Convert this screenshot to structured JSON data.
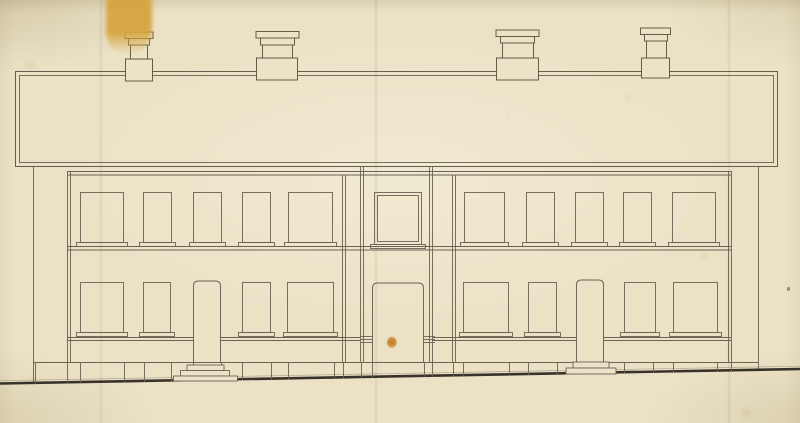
{
  "document": {
    "description": "Scanned front elevation drawing (ink on aged paper) of a two-storey terraced building with a parapet roof band, four chimney stacks, a projecting central entrance bay and two side doors with steps"
  },
  "palette": {
    "paper": "#ece3c7",
    "ink": "#6a6254",
    "ink_dark": "#55503f",
    "ground": "#38332a",
    "stain_yellow": "#d6a23c",
    "stain_orange": "#c67c26",
    "speck_brown": "#6e5f46"
  },
  "drawing": {
    "canvas": {
      "w": 800,
      "h": 423
    },
    "parapet": {
      "outer": [
        15.5,
        71.5,
        762,
        95
      ],
      "inner": [
        19.5,
        75.5,
        754,
        87
      ]
    },
    "chimneys": [
      {
        "name": "chimney-1",
        "parts": {
          "base": [
            125.5,
            59,
            27,
            22
          ],
          "stack": [
            130.5,
            44,
            17,
            15
          ],
          "neck": [
            128.5,
            38,
            21,
            7
          ],
          "cap": [
            125,
            32,
            28,
            6.5
          ]
        }
      },
      {
        "name": "chimney-2",
        "parts": {
          "base": [
            256.5,
            58,
            41,
            22
          ],
          "stack": [
            262.5,
            44,
            30,
            14
          ],
          "neck": [
            260.5,
            38,
            34,
            7
          ],
          "cap": [
            256,
            31.5,
            43,
            6.5
          ]
        }
      },
      {
        "name": "chimney-3",
        "parts": {
          "base": [
            496.5,
            58,
            42,
            22
          ],
          "stack": [
            502.5,
            42,
            31,
            16
          ],
          "neck": [
            500.5,
            36,
            34,
            7
          ],
          "cap": [
            496,
            30,
            43,
            6.5
          ]
        }
      },
      {
        "name": "chimney-4",
        "parts": {
          "base": [
            641.5,
            58,
            28,
            20
          ],
          "stack": [
            646.5,
            40,
            20,
            18
          ],
          "neck": [
            644.5,
            34,
            23,
            7
          ],
          "cap": [
            640.5,
            28,
            30,
            6.5
          ]
        }
      }
    ],
    "bands": [
      {
        "name": "eave-line-upper",
        "x1": 67,
        "x2": 731,
        "y": 171.5
      },
      {
        "name": "eave-line-lower",
        "x1": 67,
        "x2": 731,
        "y": 175
      },
      {
        "name": "string-course-upper",
        "x1": 67,
        "x2": 731,
        "y": 246.5
      },
      {
        "name": "string-course-lower",
        "x1": 67,
        "x2": 731,
        "y": 250
      },
      {
        "name": "plinth-top",
        "x1": 33,
        "x2": 758,
        "y": 362.5
      }
    ],
    "walls": [
      {
        "name": "left-end-wall",
        "x": 33.5,
        "y1": 167,
        "y2": 382
      },
      {
        "name": "facade-left-edge-outer",
        "x": 67.5,
        "y1": 171,
        "y2": 362.5
      },
      {
        "name": "facade-left-edge-inner",
        "x": 70.5,
        "y1": 171,
        "y2": 362.5
      },
      {
        "name": "porch-bay-left-outer",
        "x": 360.5,
        "y1": 167,
        "y2": 362.5
      },
      {
        "name": "porch-bay-left-inner",
        "x": 363.5,
        "y1": 167,
        "y2": 362.5
      },
      {
        "name": "porch-bay-right-inner",
        "x": 429.5,
        "y1": 167,
        "y2": 362.5
      },
      {
        "name": "porch-bay-right-outer",
        "x": 432.5,
        "y1": 167,
        "y2": 362.5
      },
      {
        "name": "downpipe-left-a",
        "x": 342.5,
        "y1": 175,
        "y2": 362
      },
      {
        "name": "downpipe-left-b",
        "x": 345.5,
        "y1": 175,
        "y2": 362
      },
      {
        "name": "downpipe-right-a",
        "x": 452.5,
        "y1": 175,
        "y2": 362
      },
      {
        "name": "downpipe-right-b",
        "x": 455.5,
        "y1": 175,
        "y2": 362
      },
      {
        "name": "facade-right-edge-inner",
        "x": 728.5,
        "y1": 171,
        "y2": 362.5
      },
      {
        "name": "facade-right-edge-outer",
        "x": 731.5,
        "y1": 171,
        "y2": 362.5
      },
      {
        "name": "right-end-wall",
        "x": 758.5,
        "y1": 167,
        "y2": 370
      }
    ],
    "sill_band": {
      "ys": [
        337.5,
        340.5
      ],
      "segments": [
        [
          67,
          193
        ],
        [
          221,
          360
        ],
        [
          433,
          576
        ],
        [
          604,
          731
        ]
      ]
    },
    "windows_upper": [
      [
        80.5,
        192.5,
        43,
        50
      ],
      [
        143.5,
        192.5,
        28,
        50
      ],
      [
        193.5,
        192.5,
        28,
        50
      ],
      [
        242.5,
        192.5,
        28,
        50
      ],
      [
        288.5,
        192.5,
        44,
        50
      ],
      [
        464.5,
        192.5,
        40,
        50
      ],
      [
        526.5,
        192.5,
        28,
        50
      ],
      [
        575.5,
        192.5,
        28,
        50
      ],
      [
        623.5,
        192.5,
        28,
        50
      ],
      [
        672.5,
        192.5,
        43,
        50
      ]
    ],
    "windows_lower": [
      [
        80.5,
        282.5,
        43,
        50
      ],
      [
        143.5,
        282.5,
        27,
        50
      ],
      [
        242.5,
        282.5,
        28,
        50
      ],
      [
        287.5,
        282.5,
        46,
        50
      ],
      [
        463.5,
        282.5,
        45,
        50
      ],
      [
        528.5,
        282.5,
        28,
        50
      ],
      [
        624.5,
        282.5,
        31,
        50
      ],
      [
        673.5,
        282.5,
        44,
        50
      ]
    ],
    "sill_inset": 4,
    "sill_h": 4,
    "center_window": {
      "outer": [
        374.5,
        192.5,
        47,
        52
      ],
      "inner": [
        377.5,
        195.5,
        41,
        46
      ],
      "sill": [
        370.5,
        244.5,
        55,
        4
      ]
    },
    "doors": [
      {
        "name": "left-house-door",
        "x": 193.5,
        "top": 281,
        "w": 27,
        "bottom": 362.5
      },
      {
        "name": "center-entrance-door",
        "x": 372.5,
        "top": 283,
        "w": 51,
        "bottom": 363
      },
      {
        "name": "right-house-door",
        "x": 576.5,
        "top": 280,
        "w": 27,
        "bottom": 362
      }
    ],
    "door_corner_radius": 5,
    "steps": [
      {
        "name": "left-door-steps",
        "rects": [
          [
            187,
            365,
            37,
            5.5
          ],
          [
            180.5,
            370.5,
            49,
            5.5
          ],
          [
            173.5,
            376,
            64,
            5
          ]
        ]
      },
      {
        "name": "right-door-steps",
        "rects": [
          [
            573,
            362,
            36,
            6
          ],
          [
            566,
            368,
            50,
            6
          ]
        ]
      }
    ],
    "plinth_joints": [
      35,
      67,
      80,
      124,
      144,
      171,
      193,
      221,
      242,
      271,
      288,
      334,
      343,
      361,
      372,
      424,
      432,
      453,
      463,
      509,
      528,
      557,
      624,
      653,
      673,
      717,
      731
    ],
    "grilles": [
      {
        "x1": 361,
        "x2": 372,
        "ys": [
          336.5,
          339.5,
          342.5
        ]
      },
      {
        "x1": 424,
        "x2": 435,
        "ys": [
          336.5,
          339.5,
          342.5
        ]
      }
    ],
    "ground": {
      "y1": 383.5,
      "y2": 369,
      "width": 2.6
    }
  },
  "artifacts": {
    "yellow_stain": {
      "x": 106,
      "y": -4,
      "w": 46,
      "h": 58
    },
    "orange_spot": {
      "x": 387,
      "y": 337,
      "w": 10,
      "h": 11
    },
    "dark_speck": {
      "x": 787,
      "y": 287,
      "w": 3,
      "h": 4
    },
    "foxing_spots": [
      [
        30,
        66,
        8,
        0.18
      ],
      [
        705,
        256,
        6,
        0.15
      ],
      [
        628,
        97,
        5,
        0.12
      ],
      [
        163,
        337,
        4,
        0.12
      ],
      [
        747,
        413,
        8,
        0.2
      ],
      [
        83,
        249,
        4,
        0.1
      ],
      [
        508,
        115,
        5,
        0.08
      ],
      [
        432,
        240,
        4,
        0.1
      ]
    ],
    "fold_creases": [
      100,
      375,
      728
    ]
  }
}
